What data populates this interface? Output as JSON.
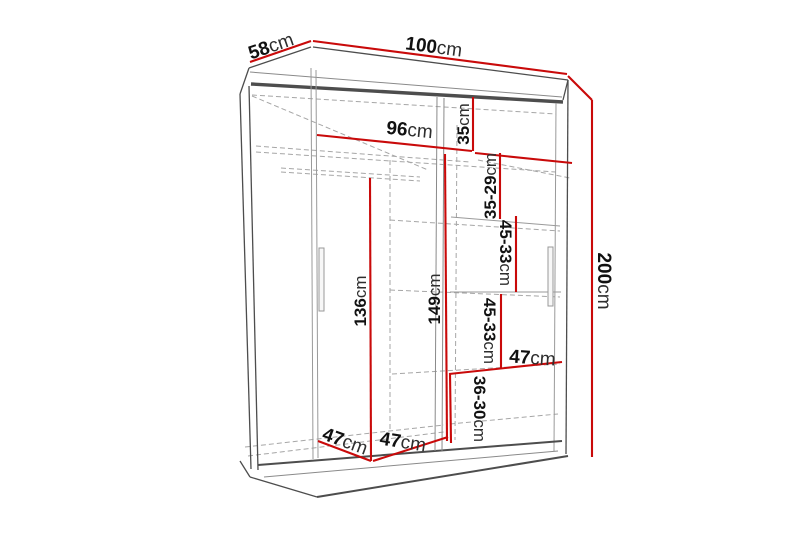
{
  "dimensions": {
    "depth": {
      "value": "58",
      "unit": "cm"
    },
    "width": {
      "value": "100",
      "unit": "cm"
    },
    "height": {
      "value": "200",
      "unit": "cm"
    },
    "interior_width": {
      "value": "96",
      "unit": "cm"
    },
    "top_shelf_drop": {
      "value": "35",
      "unit": "cm"
    },
    "upper_gap": {
      "value": "35-29",
      "unit": "cm"
    },
    "middle_gap_upper": {
      "value": "45-33",
      "unit": "cm"
    },
    "middle_gap_lower": {
      "value": "45-33",
      "unit": "cm"
    },
    "shelf_width_right": {
      "value": "47",
      "unit": "cm"
    },
    "bottom_gap": {
      "value": "36-30",
      "unit": "cm"
    },
    "divider_height": {
      "value": "149",
      "unit": "cm"
    },
    "hanging_space_height": {
      "value": "136",
      "unit": "cm"
    },
    "left_section_width": {
      "value": "47",
      "unit": "cm"
    },
    "right_section_width": {
      "value": "47",
      "unit": "cm"
    }
  },
  "colors": {
    "dimension": "#c90a0a",
    "outline": "#4d4d4d",
    "outline_light": "#8a8a8a",
    "hidden_line": "#a6a6a6",
    "label": "#111111",
    "label_unit": "#2e2e2e",
    "background": "#ffffff"
  }
}
